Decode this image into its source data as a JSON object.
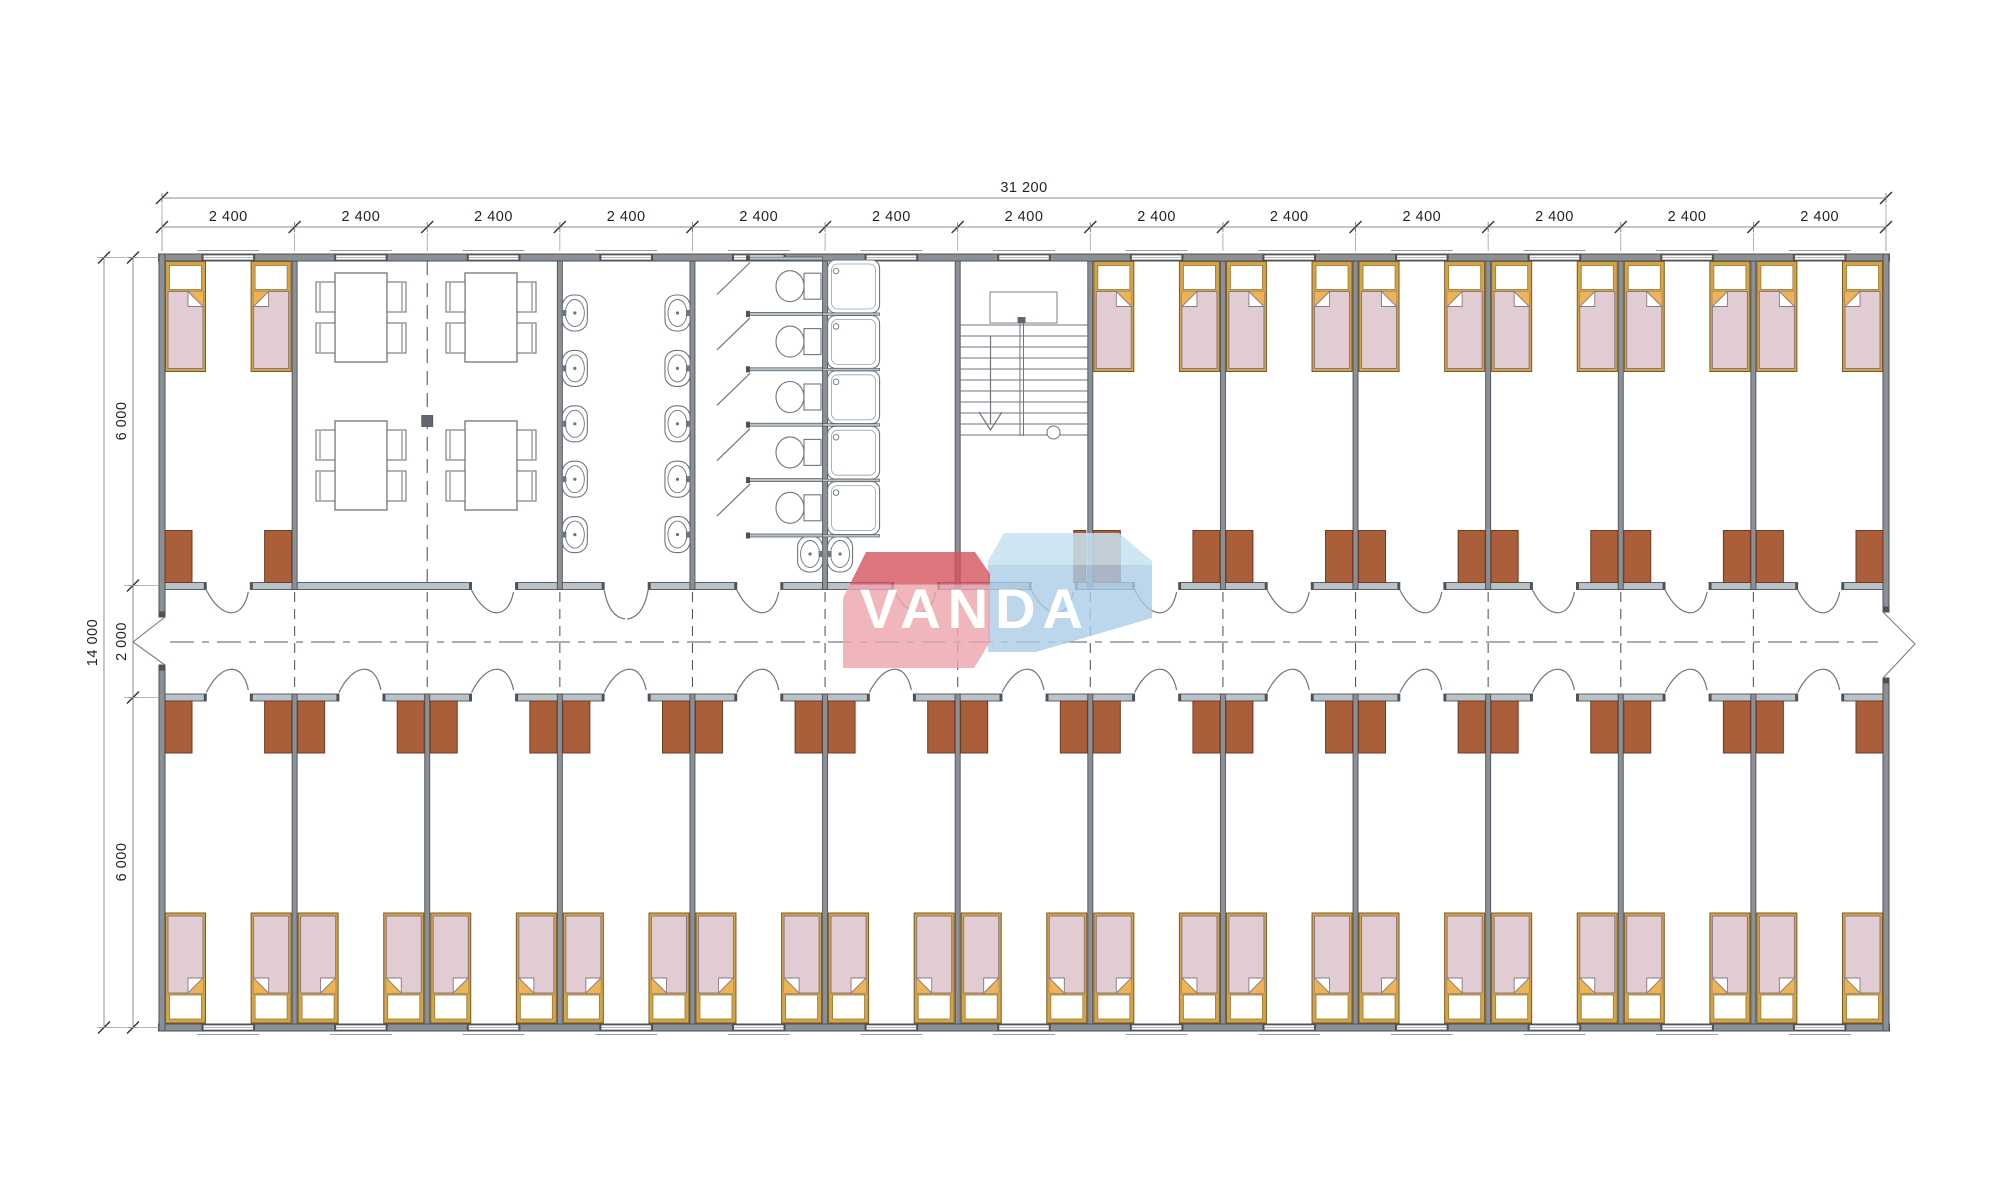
{
  "floor_plan": {
    "description": "modular dormitory building floor plan",
    "logo": {
      "text": "VANDA",
      "pink": "#eca4ac",
      "pink_dark": "#d5535e",
      "blue": "#abccе7",
      "blue_light": "#c7e1f2"
    },
    "dimensions": {
      "overall_width": "31 200",
      "module_width": "2 400",
      "module_count": 13,
      "overall_depth": "14 000",
      "room_depth_top": "6 000",
      "corridor_width": "2 000",
      "room_depth_bottom": "6 000"
    },
    "rooms_top": [
      {
        "type": "bedroom",
        "beds": 2
      },
      {
        "type": "dining",
        "span_modules": 2,
        "tables": 4,
        "chairs_per_table": 4
      },
      {
        "type": "washroom",
        "washbasins": 10
      },
      {
        "type": "toilets",
        "stalls": 5
      },
      {
        "type": "showers",
        "trays": 5,
        "washbasins": 2
      },
      {
        "type": "stairwell",
        "flights": 2
      },
      {
        "type": "bedroom",
        "rooms": 6,
        "beds_per_room": 2
      }
    ],
    "rooms_bottom": {
      "type": "bedroom",
      "rooms": 13,
      "beds_per_room": 2
    },
    "colors": {
      "wall": "#8a9096",
      "wall_dark": "#4e5257",
      "wall_light": "#b7c2c9",
      "door_leaf": "#ab5e3a",
      "door_leaf_dark": "#6f3a1f",
      "bed_frame": "#d4a348",
      "bed_frame_dark": "#7a5a20",
      "bed_blanket": "#e0ccd2",
      "bed_blanket_dark": "#8a7980",
      "fold": "#ecb457",
      "fixture_line": "#6e757c",
      "dash_line": "#565b61",
      "dim_line": "#8a8f94",
      "dim_text": "#1d2227"
    }
  }
}
